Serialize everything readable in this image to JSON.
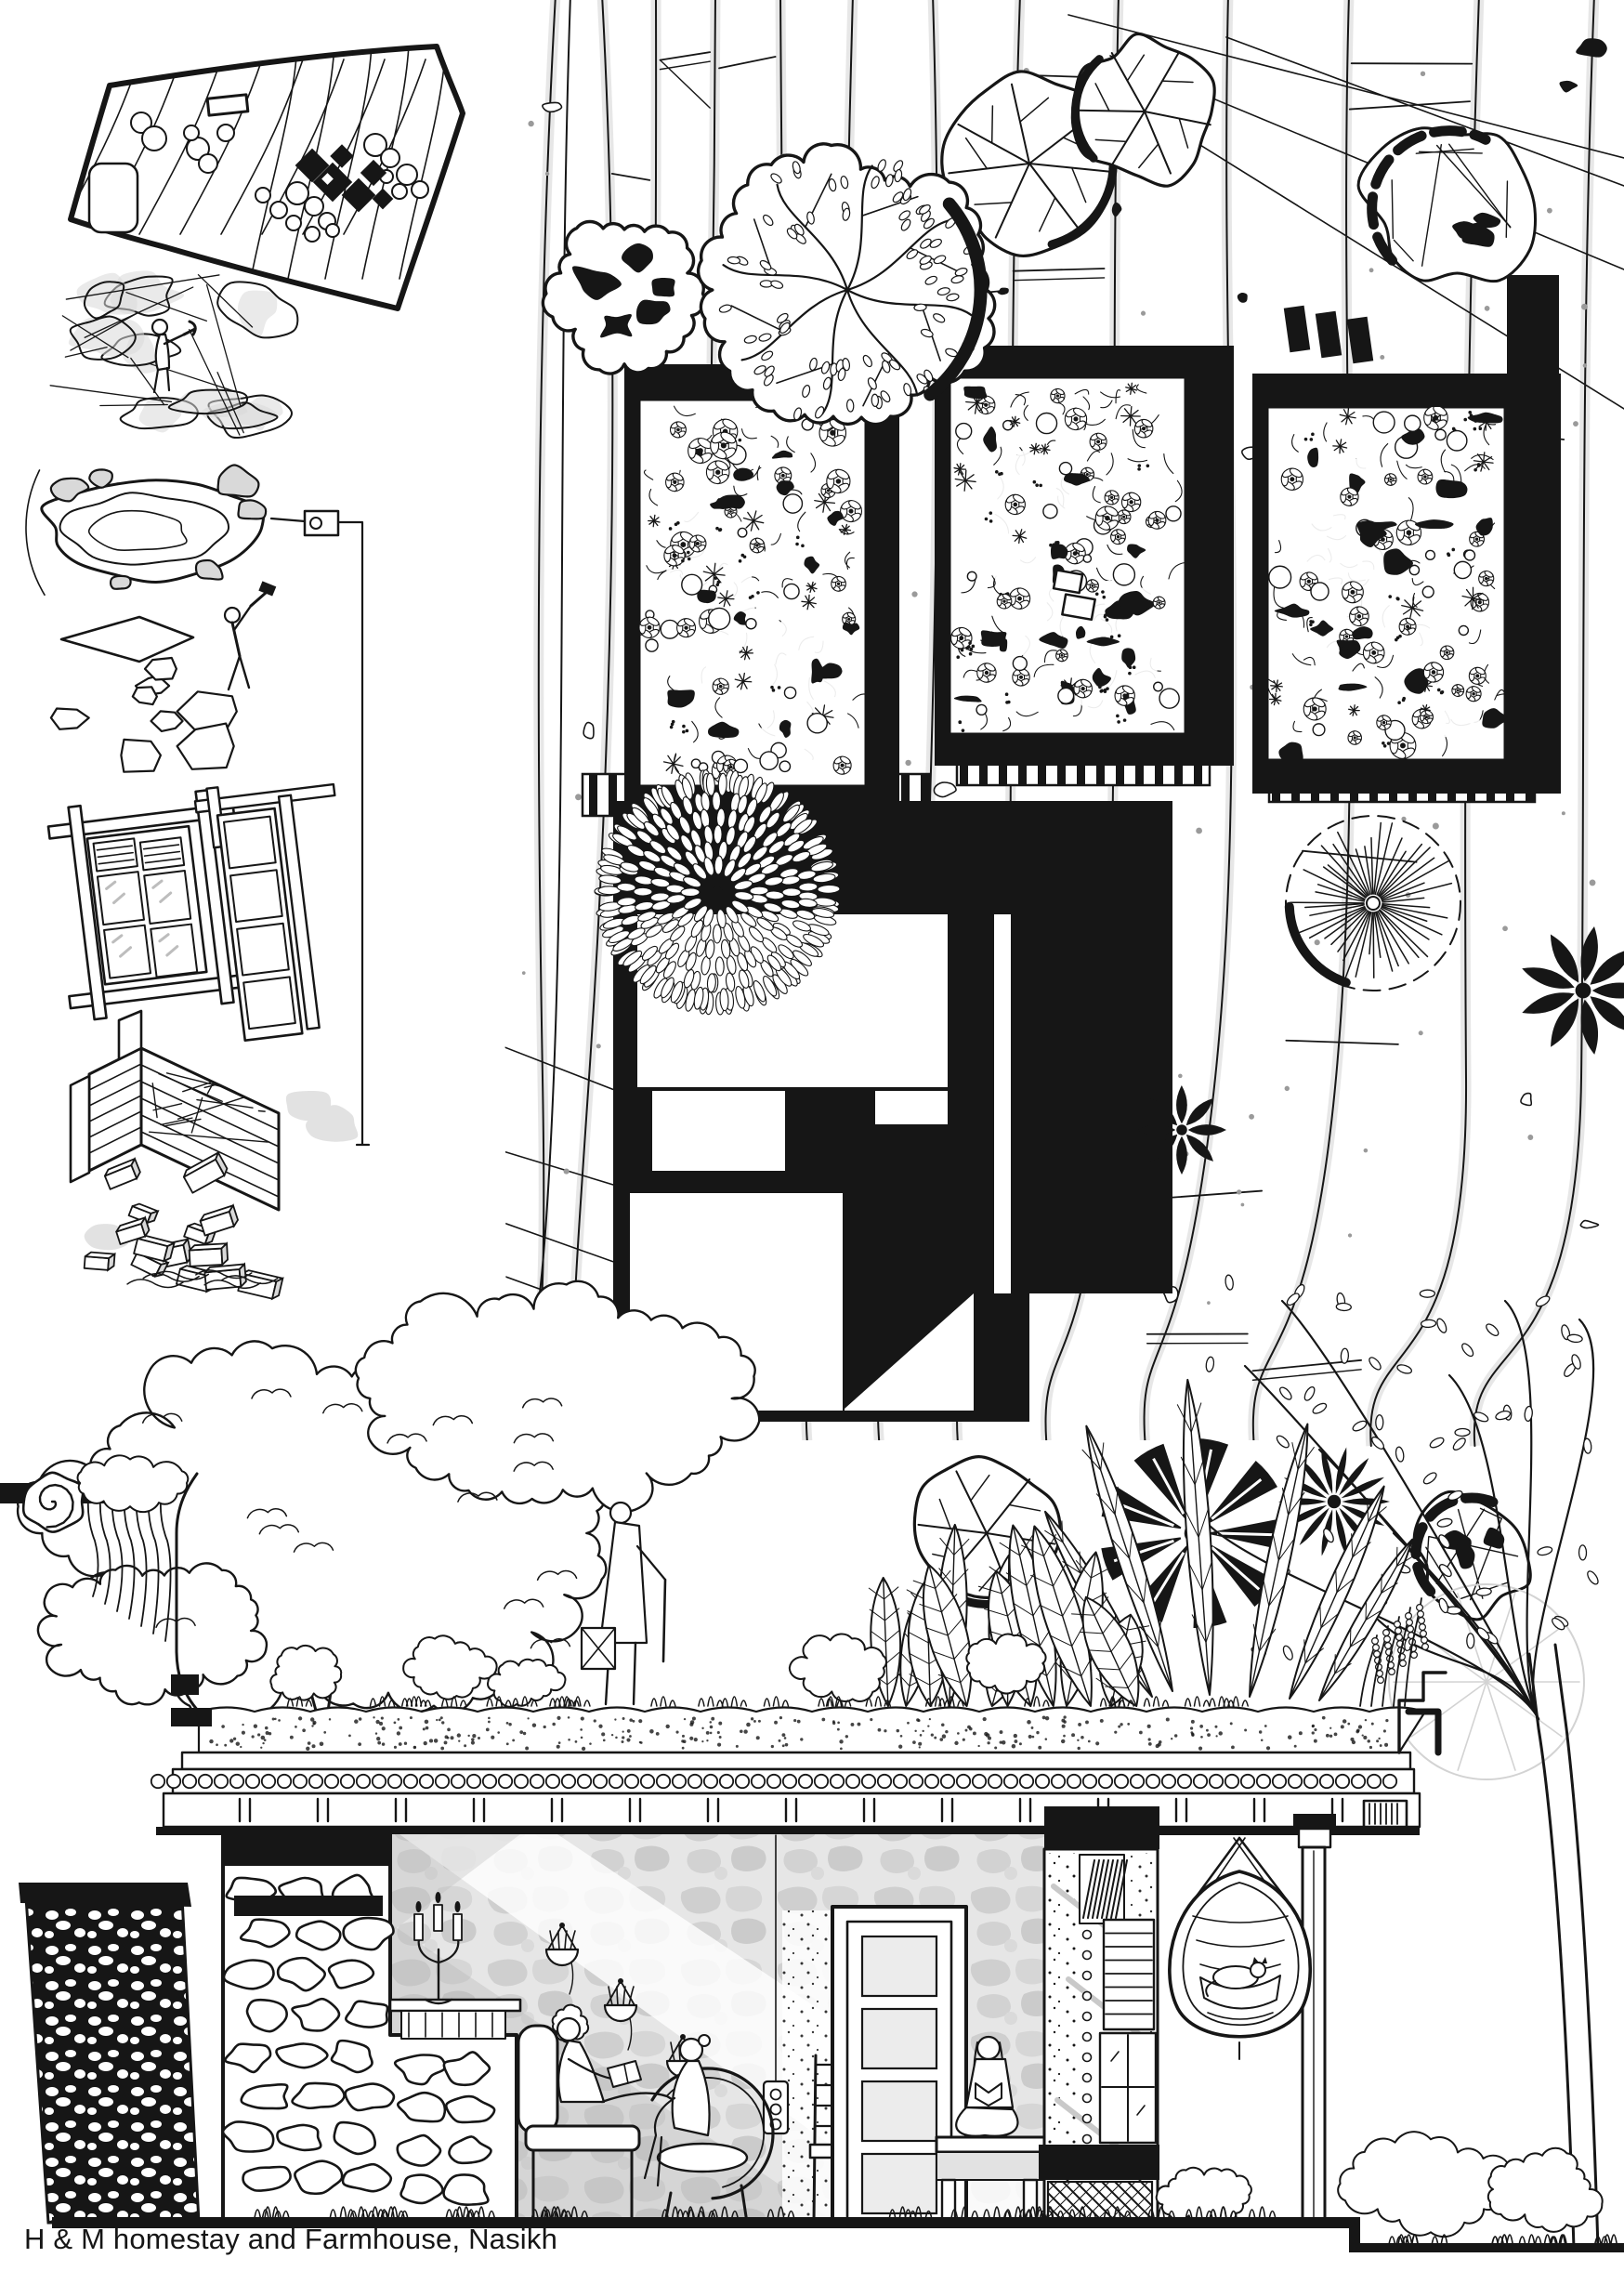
{
  "caption": "H & M homestay and Farmhouse, Nasikh",
  "palette": {
    "ink": "#161616",
    "paper": "#ffffff",
    "shade_light": "#d7d7d7",
    "shade_mid": "#b5b5b5"
  }
}
